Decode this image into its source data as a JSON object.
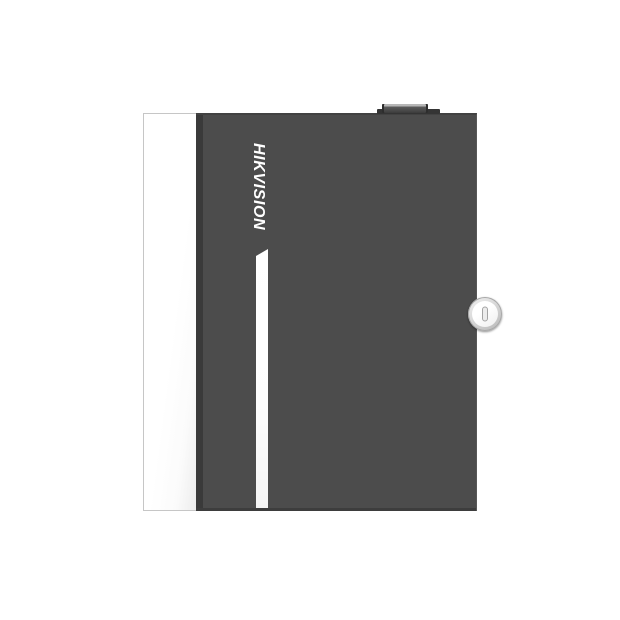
{
  "scene": {
    "type": "product-photo",
    "subject": "wall-mount metal enclosure (access controller cabinet)",
    "background_color": "#ffffff"
  },
  "device": {
    "brand_logo": "HIKVISION",
    "logo_orientation": "rotated-90deg-clockwise, reads top to bottom, bold italic",
    "parts": {
      "side_panel": "white left side panel",
      "door": "dark gray front door",
      "reflection_stripe": "thin white highlight stripe along door left edge",
      "key_lock": "round silver cam lock with vertical keyhole slot",
      "top_knob": "small dark tab/knob on top edge"
    }
  },
  "colors": {
    "background": "#ffffff",
    "door": "#4c4c4c",
    "logo": "#ffffff",
    "side-panel": "#ffffff",
    "groove": "#3a3a3a",
    "lock-ring": "#bdbdbd",
    "lock-face": "#ffffff"
  }
}
